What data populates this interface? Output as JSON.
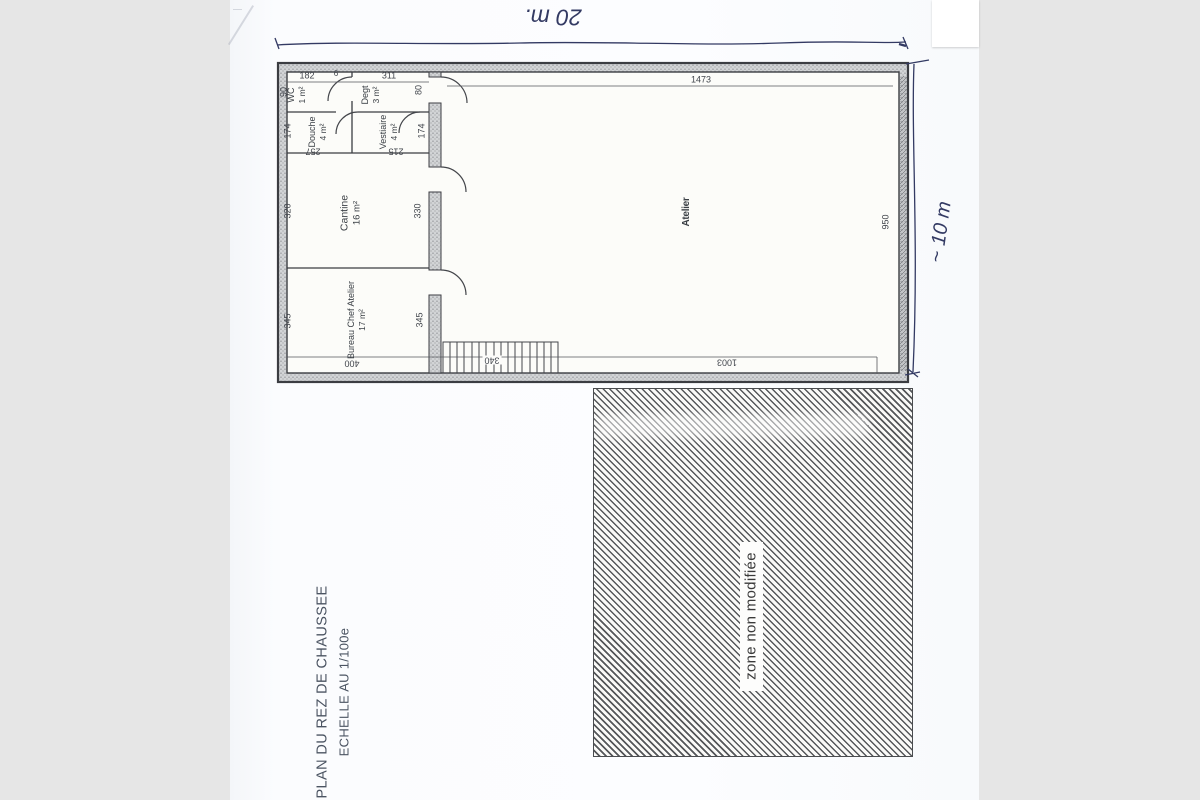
{
  "scan": {
    "title_line1": "PLAN DU REZ DE CHAUSSEE",
    "title_line2": "ECHELLE AU 1/100e",
    "handwritten_top": "20 m.",
    "handwritten_right": "~ 10 m",
    "zone_label": "zone non modifiée"
  },
  "rooms": {
    "wc": {
      "name": "WC",
      "area": "1 m²"
    },
    "degt": {
      "name": "Degt",
      "area": "3 m²"
    },
    "douche": {
      "name": "Douche",
      "area": "4 m²"
    },
    "vestiaire": {
      "name": "Vestiaire",
      "area": "4 m²"
    },
    "cantine": {
      "name": "Cantine",
      "area": "16 m²"
    },
    "bureau": {
      "name": "Bureau Chef Atelier",
      "area": "17 m²"
    },
    "atelier": {
      "name": "Atelier"
    }
  },
  "dims": {
    "d182": "182",
    "d6": "6",
    "d311": "311",
    "d1473": "1473",
    "d90": "90",
    "d174l": "174",
    "d320": "320",
    "d345l": "345",
    "d80": "80",
    "d174r": "174",
    "d330": "330",
    "d345r": "345",
    "d257": "257",
    "d215": "215",
    "d400": "400",
    "d340": "340",
    "d1003": "1003",
    "d950": "950"
  },
  "colors": {
    "ink_handwriting": "#333a63",
    "plan_lines": "#3b3d42",
    "paper": "#fbfcfe",
    "background": "#e6e6e6",
    "hatch": "#55575a"
  }
}
